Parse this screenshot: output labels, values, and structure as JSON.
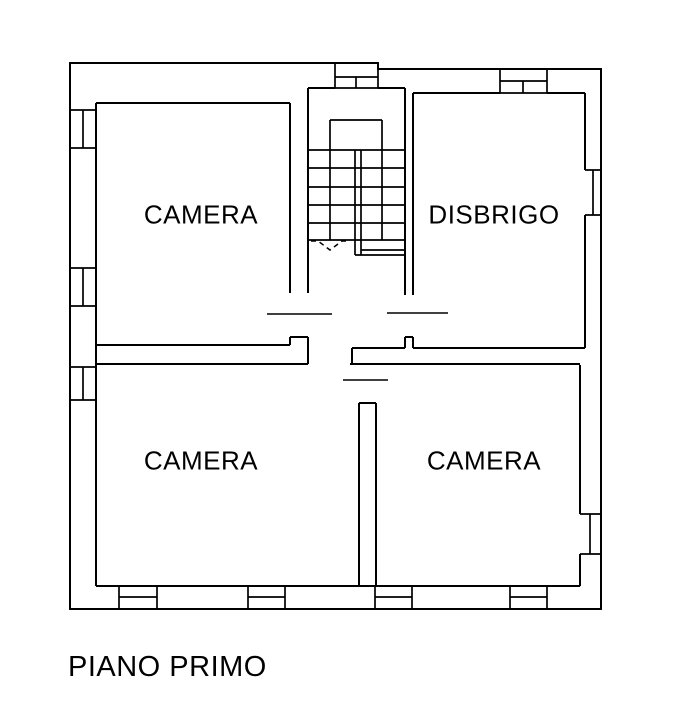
{
  "plan": {
    "title": "PIANO PRIMO",
    "rooms": [
      {
        "id": "camera-top-left",
        "label": "CAMERA"
      },
      {
        "id": "disbrigo",
        "label": "DISBRIGO"
      },
      {
        "id": "camera-bottom-left",
        "label": "CAMERA"
      },
      {
        "id": "camera-bottom-right",
        "label": "CAMERA"
      }
    ],
    "stairs": {
      "direction": "down"
    },
    "window_count": 10,
    "door_count": 3,
    "colors": {
      "line": "#000000",
      "background": "#ffffff",
      "text": "#000000"
    }
  }
}
